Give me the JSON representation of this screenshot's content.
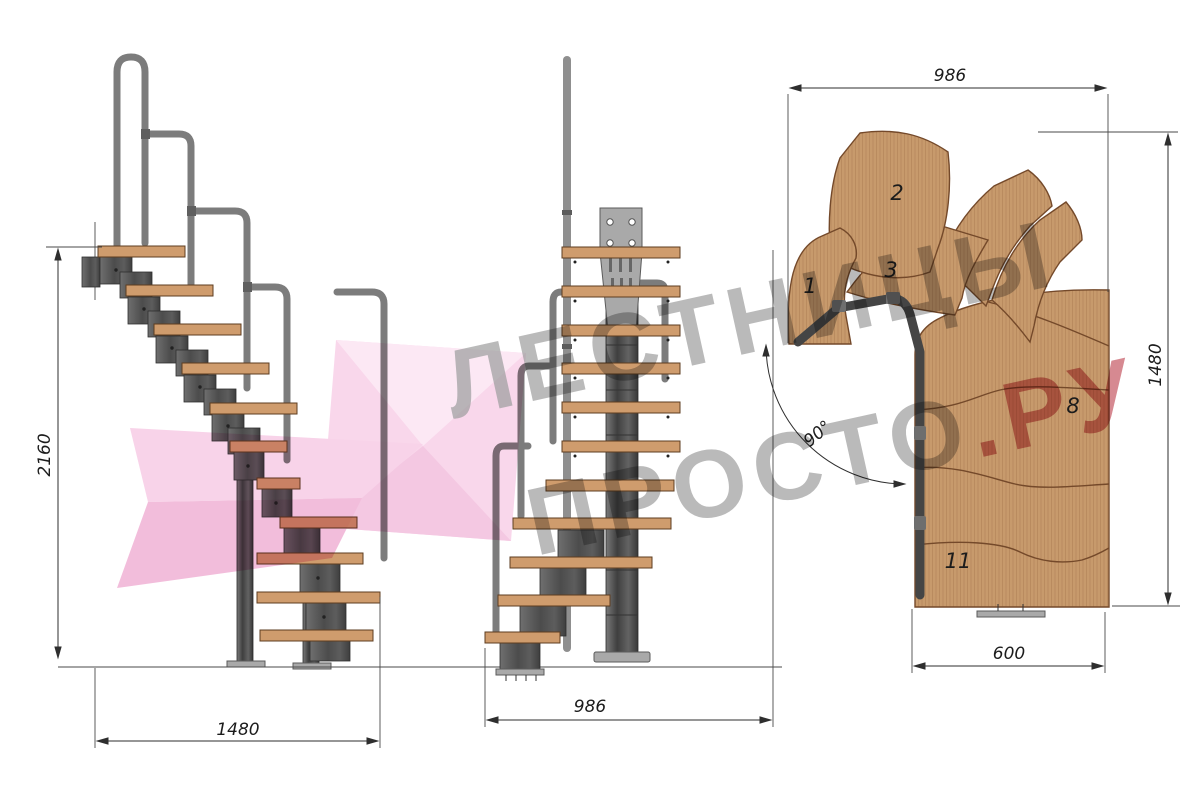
{
  "title": "Modular staircase technical drawing",
  "watermark": {
    "line1": "ЛЕСТНИЦЫ",
    "line2": "ПРОСТО",
    "suffix": ".РУ",
    "gray_color": "#8e8e8e",
    "red_color": "#c24b59",
    "pink_color": "#f6c9e4"
  },
  "side_view": {
    "height_dim": "2160",
    "width_dim": "1480"
  },
  "front_view": {
    "width_dim": "986"
  },
  "plan_view": {
    "width_dim": "986",
    "depth_dim": "1480",
    "exit_width_dim": "600",
    "turn_angle": "90°",
    "step_labels": {
      "s1": "1",
      "s2": "2",
      "s3": "3",
      "s8": "8",
      "s11": "11"
    }
  },
  "colors": {
    "wood": "#bd8a5f",
    "plan_wood": "#c79a6c",
    "metal_dark": "#565656",
    "metal_light": "#7c7c7c",
    "dimension_lines": "#2e2e2e"
  }
}
